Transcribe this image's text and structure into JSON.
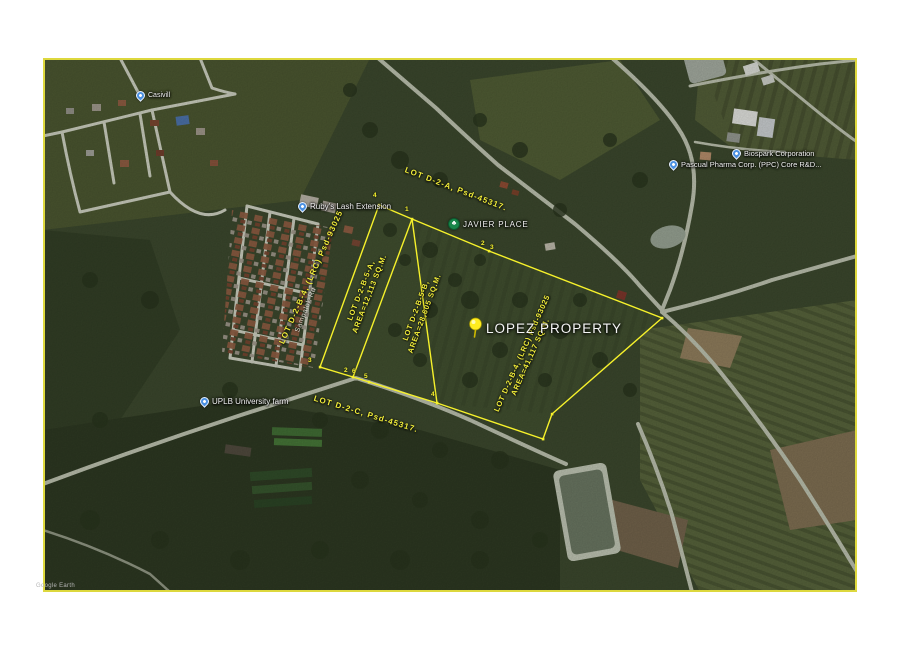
{
  "map": {
    "watermark": "Google Earth",
    "colors": {
      "survey_line": "#f6f12b",
      "map_border": "#ddd83e",
      "pin_blue": "#4a90e2",
      "tree_icon_green": "#18864a",
      "pushpin_yellow": "#ffec1f"
    },
    "places": {
      "casivill": {
        "label": "Casivill"
      },
      "rubys": {
        "label": "Ruby's Lash Extension"
      },
      "javier": {
        "label": "JAVIER PLACE"
      },
      "lopez": {
        "label": "LOPEZ PROPERTY"
      },
      "uplb": {
        "label": "UPLB University farm"
      },
      "biospark": {
        "label": "Biospark Corporation"
      },
      "pascual": {
        "label": "Pascual Pharma Corp. (PPC) Core R&D..."
      },
      "road": {
        "label": "Sampalok Rd"
      }
    },
    "lots": {
      "d2a": {
        "text": "LOT  D-2-A,  Psd-45317."
      },
      "d2c": {
        "text": "LOT  D-2-C,  Psd-45317."
      },
      "b4_left": {
        "text": "LOT D-2-B-4,  (LRC) Psd-93025"
      },
      "b5a": {
        "line1": "LOT D-2-B-5-A,",
        "line2": "AREA=12,113  SQ.M."
      },
      "b5b": {
        "line1": "LOT D-2-B-5-B,",
        "line2": "AREA=28,605  SQ.M."
      },
      "b4_right": {
        "line1": "LOT D-2-B-4,  (LRC) Psd-93025",
        "line2": "AREA=41,117  SQ.M."
      }
    },
    "vertices": [
      {
        "n": "4"
      },
      {
        "n": "1"
      },
      {
        "n": "2"
      },
      {
        "n": "3"
      },
      {
        "n": "3"
      },
      {
        "n": "2"
      },
      {
        "n": "6"
      },
      {
        "n": "5"
      },
      {
        "n": "4"
      }
    ]
  }
}
